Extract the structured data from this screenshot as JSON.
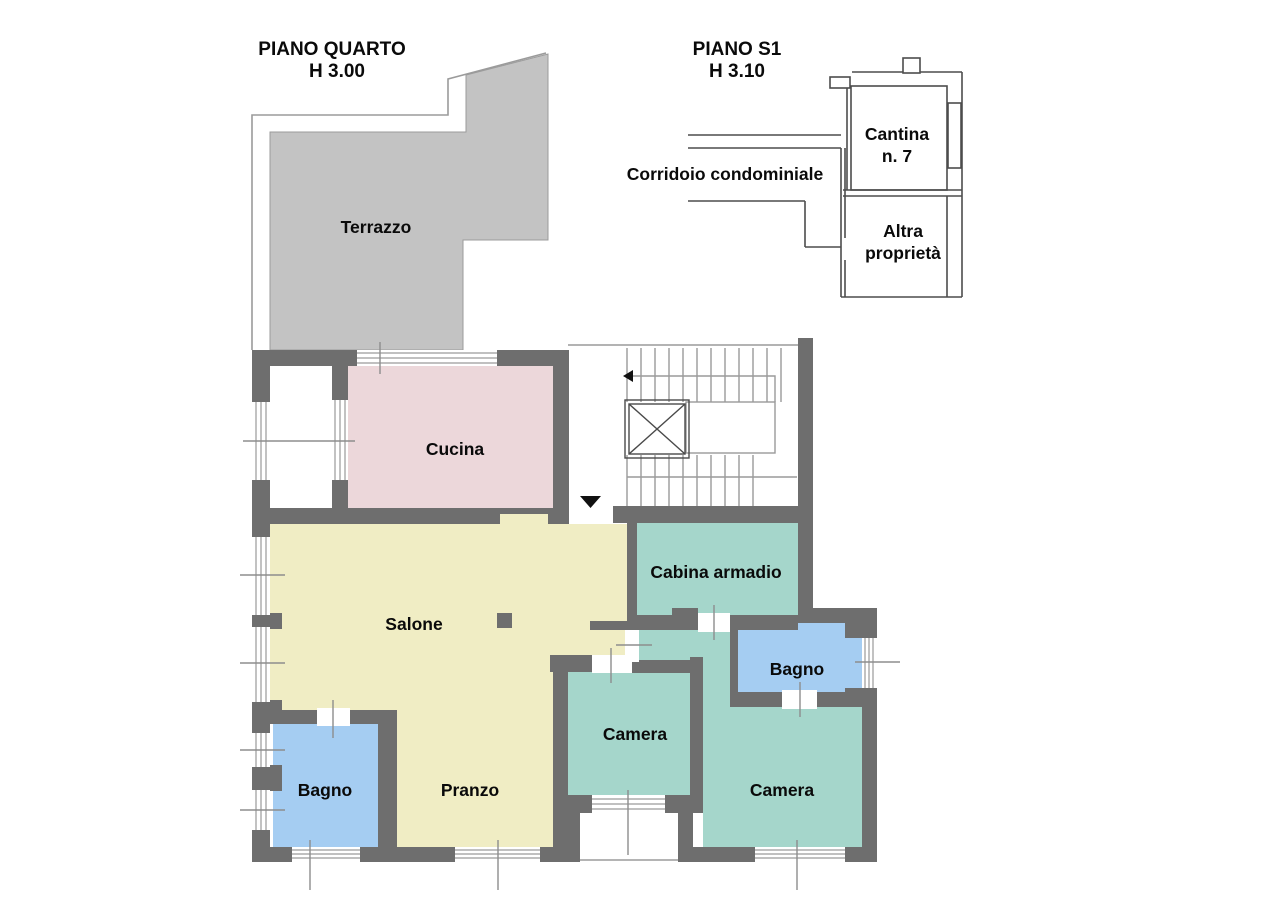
{
  "colors": {
    "background": "#ffffff",
    "wall": "#6e6e6e",
    "terrace": "#c3c3c3",
    "kitchen": "#ecd7da",
    "living": "#f0edc4",
    "bedroom": "#a5d6cb",
    "bath": "#a5cdf2",
    "outline": "#9b9b9b",
    "text": "#0a0a0a"
  },
  "plan_quarto": {
    "title": "PIANO QUARTO",
    "height": "H 3.00",
    "rooms": {
      "terrazzo": "Terrazzo",
      "cucina": "Cucina",
      "salone": "Salone",
      "pranzo": "Pranzo",
      "bagno_left": "Bagno",
      "bagno_right": "Bagno",
      "camera_small": "Camera",
      "camera_large": "Camera",
      "cabina_armadio": "Cabina armadio"
    }
  },
  "plan_s1": {
    "title": "PIANO S1",
    "height": "H 3.10",
    "areas": {
      "corridoio": "Corridoio condominiale",
      "cantina_line1": "Cantina",
      "cantina_line2": "n. 7",
      "altra_line1": "Altra",
      "altra_line2": "proprietà"
    }
  }
}
